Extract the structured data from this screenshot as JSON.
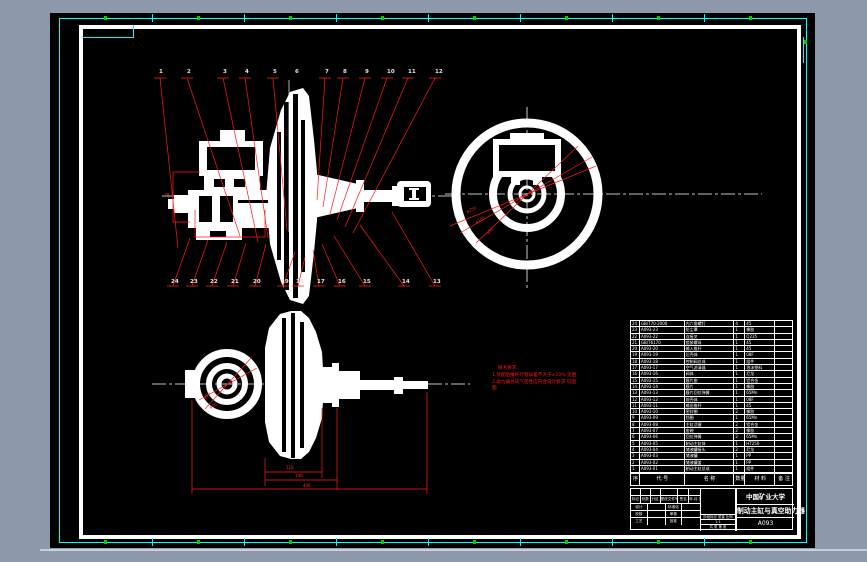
{
  "drawing": {
    "top_part_numbers": [
      "1",
      "2",
      "3",
      "4",
      "5",
      "6",
      "7",
      "8",
      "9",
      "10",
      "11",
      "12"
    ],
    "bottom_part_numbers": [
      "24",
      "23",
      "22",
      "21",
      "20",
      "19",
      "18",
      "17",
      "16",
      "15",
      "14",
      "13"
    ],
    "technical_notes": [
      "技术要求:",
      "1.装配后推杆行程误差不大于±10% 见图",
      "2.助力器总成气密性应符合设计要求 见图",
      "图"
    ],
    "dimensions": {
      "main_left": "28",
      "end_view_diams": [
        "φ250",
        "φ105",
        "φ52"
      ],
      "bottom_view_diams": [
        "φ56",
        "φ40"
      ],
      "bottom_view_lengths": [
        "118",
        "146",
        "406"
      ]
    }
  },
  "bom": {
    "headers": {
      "seq": "序",
      "code": "代 号",
      "name": "名 称",
      "qty": "数量",
      "material": "材 料",
      "remark": "备 注"
    },
    "rows": [
      {
        "seq": "24",
        "code": "GB/T70-2000",
        "name": "内六角螺钉",
        "qty": "4",
        "material": "45",
        "remark": ""
      },
      {
        "seq": "23",
        "code": "A093-23",
        "name": "防尘罩",
        "qty": "1",
        "material": "橡胶",
        "remark": ""
      },
      {
        "seq": "22",
        "code": "A093-22",
        "name": "连接叉",
        "qty": "1",
        "material": "Q235",
        "remark": ""
      },
      {
        "seq": "21",
        "code": "GB/T6170",
        "name": "锁紧螺母",
        "qty": "1",
        "material": "45",
        "remark": ""
      },
      {
        "seq": "20",
        "code": "A093-20",
        "name": "输入推杆",
        "qty": "1",
        "material": "45",
        "remark": ""
      },
      {
        "seq": "19",
        "code": "A093-19",
        "name": "后壳体",
        "qty": "1",
        "material": "08F",
        "remark": ""
      },
      {
        "seq": "18",
        "code": "A093-18",
        "name": "控制阀总成",
        "qty": "1",
        "material": "组件",
        "remark": ""
      },
      {
        "seq": "17",
        "code": "A093-17",
        "name": "空气滤清器",
        "qty": "1",
        "material": "泡沫塑料",
        "remark": ""
      },
      {
        "seq": "16",
        "code": "A093-16",
        "name": "阀体",
        "qty": "1",
        "material": "尼龙",
        "remark": ""
      },
      {
        "seq": "15",
        "code": "A093-15",
        "name": "膜片座",
        "qty": "1",
        "material": "铝合金",
        "remark": ""
      },
      {
        "seq": "14",
        "code": "A093-14",
        "name": "膜片",
        "qty": "1",
        "material": "橡胶",
        "remark": ""
      },
      {
        "seq": "13",
        "code": "A093-13",
        "name": "膜片回位弹簧",
        "qty": "1",
        "material": "65Mn",
        "remark": ""
      },
      {
        "seq": "12",
        "code": "A093-12",
        "name": "前壳体",
        "qty": "1",
        "material": "08F",
        "remark": ""
      },
      {
        "seq": "11",
        "code": "A093-11",
        "name": "输出推杆",
        "qty": "1",
        "material": "45",
        "remark": ""
      },
      {
        "seq": "10",
        "code": "A093-10",
        "name": "密封圈",
        "qty": "2",
        "material": "橡胶",
        "remark": ""
      },
      {
        "seq": "9",
        "code": "A093-09",
        "name": "挡圈",
        "qty": "1",
        "material": "65Mn",
        "remark": ""
      },
      {
        "seq": "8",
        "code": "A093-08",
        "name": "主缸活塞",
        "qty": "2",
        "material": "铝合金",
        "remark": ""
      },
      {
        "seq": "7",
        "code": "A093-07",
        "name": "皮碗",
        "qty": "2",
        "material": "橡胶",
        "remark": ""
      },
      {
        "seq": "6",
        "code": "A093-06",
        "name": "回位弹簧",
        "qty": "2",
        "material": "65Mn",
        "remark": ""
      },
      {
        "seq": "5",
        "code": "A093-05",
        "name": "制动主缸体",
        "qty": "1",
        "material": "HT250",
        "remark": ""
      },
      {
        "seq": "4",
        "code": "A093-04",
        "name": "储液罐接头",
        "qty": "2",
        "material": "尼龙",
        "remark": ""
      },
      {
        "seq": "3",
        "code": "A093-03",
        "name": "储液罐",
        "qty": "1",
        "material": "PP",
        "remark": ""
      },
      {
        "seq": "2",
        "code": "A093-02",
        "name": "储液罐盖",
        "qty": "1",
        "material": "PP",
        "remark": ""
      },
      {
        "seq": "1",
        "code": "A093-01",
        "name": "制动主缸总成",
        "qty": "1",
        "material": "组件",
        "remark": ""
      }
    ]
  },
  "title_block": {
    "university": "中国矿业大学",
    "drawing_title": "制动主缸与真空助力器",
    "drawing_number": "A093",
    "scale": "1:1",
    "change_labels": [
      "标记",
      "处数",
      "分区",
      "更改文件号",
      "签名",
      "年.月.日"
    ],
    "sign_labels": [
      "设计",
      "校核",
      "审核",
      "工艺",
      "批准",
      "标准化"
    ],
    "stage_label": "阶段标记 质量 比例",
    "sheet_label": "共 张 第 张"
  }
}
